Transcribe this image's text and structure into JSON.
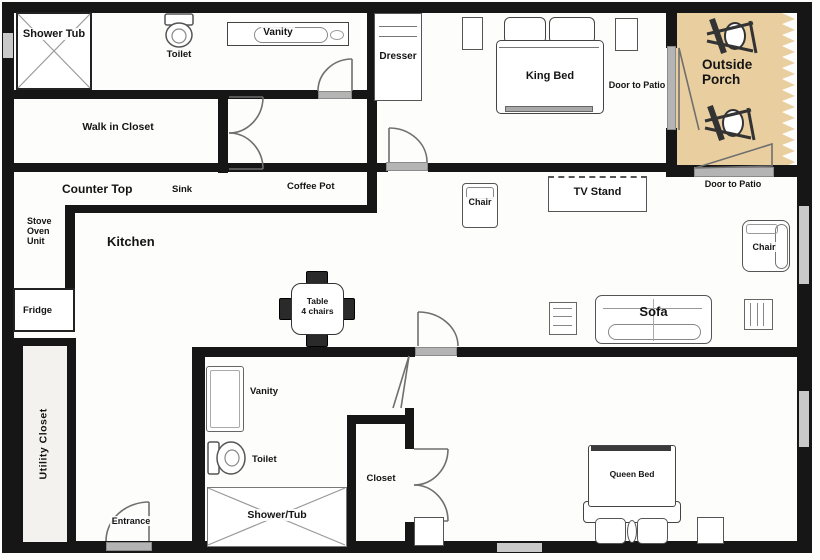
{
  "palette": {
    "wall": "#161616",
    "porch_tan": "#e9cfa0",
    "door_sill_gray": "#b4b4b4",
    "utility_bg": "#f3f2ee",
    "paper": "#fdfdfc"
  },
  "top_bath": {
    "shower_tub": "Shower Tub",
    "toilet": "Toilet",
    "vanity": "Vanity"
  },
  "walk_in_closet": {
    "label": "Walk in Closet"
  },
  "king_bedroom": {
    "dresser": "Dresser",
    "king_bed": "King Bed",
    "door_to_patio": "Door to Patio"
  },
  "porch": {
    "label": "Outside Porch",
    "door_to_patio": "Door to Patio"
  },
  "kitchen": {
    "counter_top": "Counter Top",
    "sink": "Sink",
    "coffee_pot": "Coffee Pot",
    "stove_oven_unit": "Stove Oven Unit",
    "label": "Kitchen",
    "fridge": "Fridge",
    "table_line1": "Table",
    "table_line2": "4 chairs"
  },
  "living_room": {
    "chair_left": "Chair",
    "tv_stand": "TV Stand",
    "chair_right": "Chair",
    "sofa": "Sofa"
  },
  "utility_closet": {
    "label": "Utility Closet"
  },
  "entrance": {
    "label": "Entrance"
  },
  "bottom_bath": {
    "vanity": "Vanity",
    "toilet": "Toilet",
    "shower_tub": "Shower/Tub",
    "closet": "Closet"
  },
  "queen_bedroom": {
    "queen_bed": "Queen Bed"
  }
}
